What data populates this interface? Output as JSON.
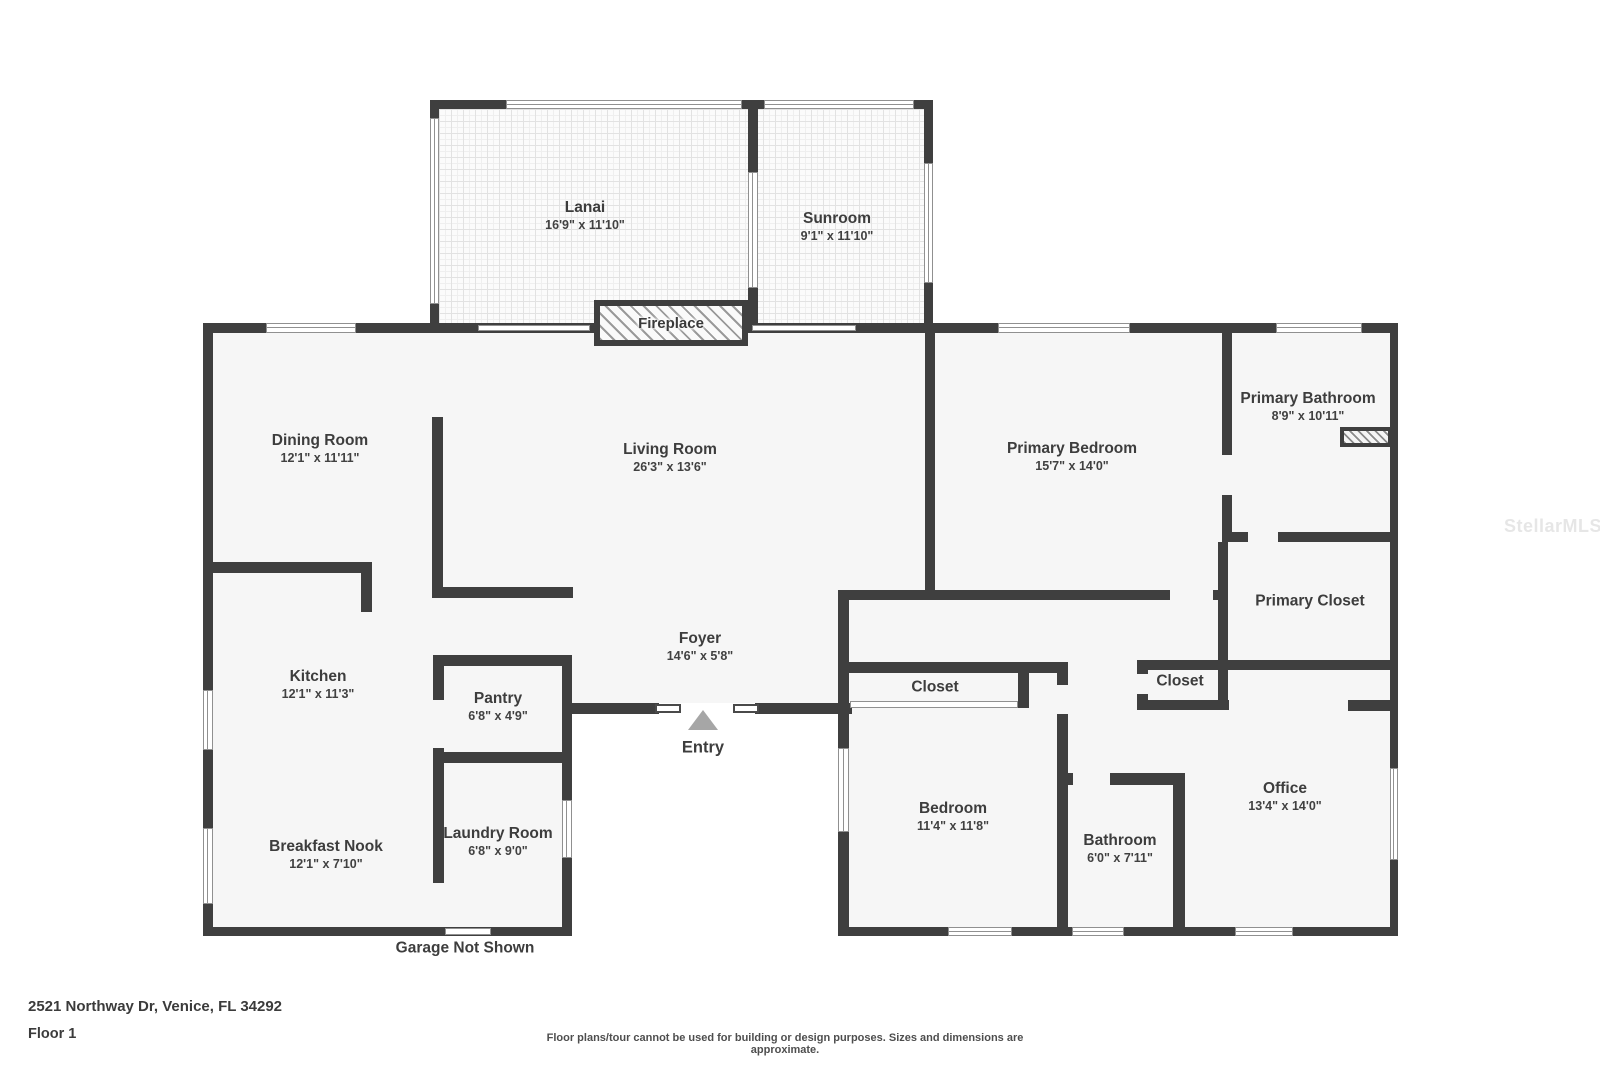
{
  "rooms": {
    "lanai": {
      "name": "Lanai",
      "dims": "16'9\" x 11'10\""
    },
    "sunroom": {
      "name": "Sunroom",
      "dims": "9'1\" x 11'10\""
    },
    "fireplace": {
      "name": "Fireplace"
    },
    "dining": {
      "name": "Dining Room",
      "dims": "12'1\" x 11'11\""
    },
    "living": {
      "name": "Living Room",
      "dims": "26'3\" x 13'6\""
    },
    "primary_bedroom": {
      "name": "Primary Bedroom",
      "dims": "15'7\" x 14'0\""
    },
    "primary_bathroom": {
      "name": "Primary Bathroom",
      "dims": "8'9\" x 10'11\""
    },
    "primary_closet": {
      "name": "Primary Closet"
    },
    "kitchen": {
      "name": "Kitchen",
      "dims": "12'1\" x 11'3\""
    },
    "pantry": {
      "name": "Pantry",
      "dims": "6'8\" x 4'9\""
    },
    "foyer": {
      "name": "Foyer",
      "dims": "14'6\" x 5'8\""
    },
    "entry": {
      "name": "Entry"
    },
    "closet_bedroom": {
      "name": "Closet"
    },
    "closet_office": {
      "name": "Closet"
    },
    "breakfast_nook": {
      "name": "Breakfast Nook",
      "dims": "12'1\" x 7'10\""
    },
    "laundry": {
      "name": "Laundry Room",
      "dims": "6'8\" x 9'0\""
    },
    "bedroom": {
      "name": "Bedroom",
      "dims": "11'4\" x 11'8\""
    },
    "bathroom": {
      "name": "Bathroom",
      "dims": "6'0\" x 7'11\""
    },
    "office": {
      "name": "Office",
      "dims": "13'4\" x 14'0\""
    }
  },
  "notes": {
    "garage": "Garage Not Shown"
  },
  "footer": {
    "address": "2521 Northway Dr, Venice, FL 34292",
    "floor": "Floor 1",
    "disclaimer": "Floor plans/tour cannot be used for building or design purposes. Sizes and dimensions are approximate."
  },
  "watermark": "StellarMLS",
  "colors": {
    "wall": "#3f3f3f",
    "floor": "#f6f6f6",
    "background": "#ffffff"
  }
}
